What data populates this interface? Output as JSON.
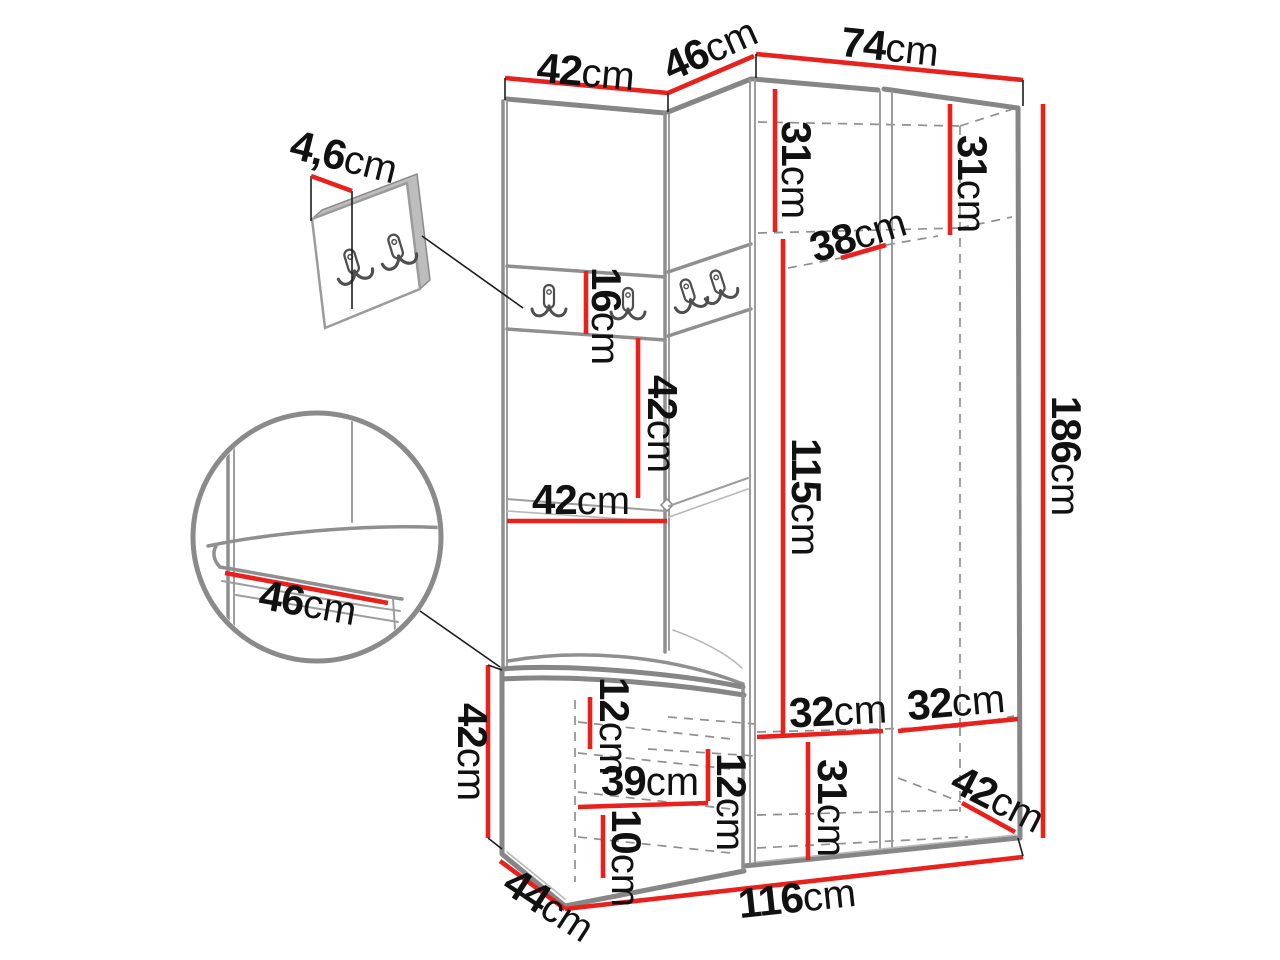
{
  "diagram": {
    "kind": "furniture-dimension-diagram",
    "unit": "cm",
    "colors": {
      "dimension_line": "#e8211c",
      "outline": "#868686",
      "label_text": "#111111",
      "background": "#ffffff"
    }
  },
  "dims": {
    "top_panel_width": {
      "value": "42",
      "unit": "cm"
    },
    "top_corner_width": {
      "value": "46",
      "unit": "cm"
    },
    "top_wardrobe_width": {
      "value": "74",
      "unit": "cm"
    },
    "hook_panel_thickness": {
      "value": "4,6",
      "unit": "cm"
    },
    "shelf_left_height": {
      "value": "31",
      "unit": "cm"
    },
    "shelf_right_height": {
      "value": "31",
      "unit": "cm"
    },
    "shelf_depth": {
      "value": "38",
      "unit": "cm"
    },
    "hook_rail_height": {
      "value": "16",
      "unit": "cm"
    },
    "mid_panel_height": {
      "value": "42",
      "unit": "cm"
    },
    "mid_panel_width": {
      "value": "42",
      "unit": "cm"
    },
    "hanging_space_height": {
      "value": "115",
      "unit": "cm"
    },
    "total_height": {
      "value": "186",
      "unit": "cm"
    },
    "bench_seat_depth": {
      "value": "46",
      "unit": "cm"
    },
    "bench_height": {
      "value": "42",
      "unit": "cm"
    },
    "bench_top_gap": {
      "value": "12",
      "unit": "cm"
    },
    "bench_inner_width": {
      "value": "39",
      "unit": "cm"
    },
    "bench_shelf_gap": {
      "value": "12",
      "unit": "cm"
    },
    "bench_bottom_height": {
      "value": "10",
      "unit": "cm"
    },
    "lower_compartment_height": {
      "value": "31",
      "unit": "cm"
    },
    "lower_left_width": {
      "value": "32",
      "unit": "cm"
    },
    "lower_right_width": {
      "value": "32",
      "unit": "cm"
    },
    "lower_right_depth": {
      "value": "42",
      "unit": "cm"
    },
    "bench_depth": {
      "value": "44",
      "unit": "cm"
    },
    "total_width": {
      "value": "116",
      "unit": "cm"
    }
  }
}
